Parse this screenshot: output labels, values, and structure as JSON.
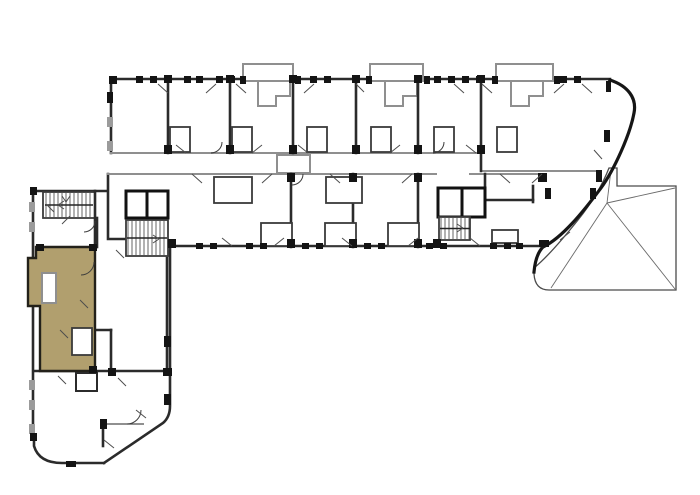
{
  "meta": {
    "title": "Residential building floor plan",
    "type": "architectural-floor-plan",
    "description": "L-shaped apartment building plan with one unit highlighted in the lower-left wing, three stair cores, top balcony bump-outs and a curved east end with a roof terrace."
  },
  "colors": {
    "background": "#ffffff",
    "wall_dark": "#2b2b2b",
    "wall_black": "#141414",
    "wall_gray": "#8f8f8f",
    "thin_line": "#4d4d4d",
    "marker_black": "#141414",
    "marker_gray": "#9b9b9b",
    "highlight_fill": "#b19f6e",
    "highlight_outline": "#23211a"
  },
  "highlighted_unit": {
    "id": "unit-lower-left",
    "status": "selected",
    "wing": "south-west"
  },
  "stairwells": [
    {
      "name": "stairwell-west",
      "x": 46,
      "y": 193,
      "w": 46,
      "h": 24,
      "step": 4
    },
    {
      "name": "stairwell-central",
      "x": 128,
      "y": 221,
      "w": 38,
      "h": 34,
      "step": 4
    },
    {
      "name": "stairwell-east",
      "x": 441,
      "y": 218,
      "w": 28,
      "h": 21,
      "step": 4
    }
  ],
  "window_markers": [
    [
      136,
      76,
      7,
      7,
      "b"
    ],
    [
      150,
      76,
      7,
      7,
      "b"
    ],
    [
      184,
      76,
      7,
      7,
      "b"
    ],
    [
      196,
      76,
      7,
      7,
      "b"
    ],
    [
      216,
      76,
      7,
      7,
      "b"
    ],
    [
      228,
      76,
      7,
      7,
      "b"
    ],
    [
      310,
      76,
      7,
      7,
      "b"
    ],
    [
      324,
      76,
      7,
      7,
      "b"
    ],
    [
      434,
      76,
      7,
      7,
      "b"
    ],
    [
      448,
      76,
      7,
      7,
      "b"
    ],
    [
      462,
      76,
      7,
      7,
      "b"
    ],
    [
      476,
      76,
      7,
      7,
      "b"
    ],
    [
      560,
      76,
      7,
      7,
      "b"
    ],
    [
      574,
      76,
      7,
      7,
      "b"
    ],
    [
      240,
      76,
      6,
      8,
      "b"
    ],
    [
      295,
      76,
      6,
      8,
      "b"
    ],
    [
      366,
      76,
      6,
      8,
      "b"
    ],
    [
      424,
      76,
      6,
      8,
      "b"
    ],
    [
      492,
      76,
      6,
      8,
      "b"
    ],
    [
      554,
      76,
      6,
      8,
      "b"
    ],
    [
      164,
      75,
      8,
      8,
      "b"
    ],
    [
      226,
      75,
      8,
      8,
      "b"
    ],
    [
      289,
      75,
      8,
      8,
      "b"
    ],
    [
      352,
      75,
      8,
      8,
      "b"
    ],
    [
      414,
      75,
      8,
      8,
      "b"
    ],
    [
      477,
      75,
      8,
      8,
      "b"
    ],
    [
      164,
      145,
      8,
      9,
      "b"
    ],
    [
      226,
      145,
      8,
      9,
      "b"
    ],
    [
      289,
      145,
      8,
      9,
      "b"
    ],
    [
      352,
      145,
      8,
      9,
      "b"
    ],
    [
      414,
      145,
      8,
      9,
      "b"
    ],
    [
      477,
      145,
      8,
      9,
      "b"
    ],
    [
      287,
      173,
      8,
      9,
      "b"
    ],
    [
      349,
      173,
      8,
      9,
      "b"
    ],
    [
      414,
      173,
      8,
      9,
      "b"
    ],
    [
      538,
      173,
      9,
      9,
      "b"
    ],
    [
      168,
      239,
      8,
      9,
      "b"
    ],
    [
      287,
      239,
      8,
      9,
      "b"
    ],
    [
      349,
      239,
      8,
      9,
      "b"
    ],
    [
      414,
      239,
      8,
      9,
      "b"
    ],
    [
      433,
      239,
      8,
      9,
      "b"
    ],
    [
      539,
      240,
      10,
      7,
      "b"
    ],
    [
      196,
      243,
      7,
      6,
      "b"
    ],
    [
      210,
      243,
      7,
      6,
      "b"
    ],
    [
      246,
      243,
      7,
      6,
      "b"
    ],
    [
      260,
      243,
      7,
      6,
      "b"
    ],
    [
      302,
      243,
      7,
      6,
      "b"
    ],
    [
      316,
      243,
      7,
      6,
      "b"
    ],
    [
      364,
      243,
      7,
      6,
      "b"
    ],
    [
      378,
      243,
      7,
      6,
      "b"
    ],
    [
      426,
      243,
      7,
      6,
      "b"
    ],
    [
      440,
      243,
      7,
      6,
      "b"
    ],
    [
      490,
      243,
      7,
      6,
      "b"
    ],
    [
      504,
      243,
      7,
      6,
      "b"
    ],
    [
      516,
      243,
      7,
      6,
      "b"
    ],
    [
      29,
      202,
      6,
      10,
      "g"
    ],
    [
      29,
      222,
      6,
      10,
      "g"
    ],
    [
      29,
      380,
      6,
      10,
      "g"
    ],
    [
      29,
      400,
      6,
      10,
      "g"
    ],
    [
      29,
      424,
      6,
      10,
      "g"
    ],
    [
      107,
      117,
      6,
      10,
      "g"
    ],
    [
      107,
      141,
      6,
      10,
      "g"
    ],
    [
      107,
      92,
      6,
      11,
      "b"
    ],
    [
      164,
      336,
      7,
      11,
      "b"
    ],
    [
      164,
      394,
      7,
      11,
      "b"
    ],
    [
      100,
      419,
      7,
      10,
      "b"
    ],
    [
      66,
      461,
      10,
      6,
      "b"
    ],
    [
      545,
      188,
      6,
      11,
      "b"
    ],
    [
      590,
      188,
      6,
      11,
      "b"
    ],
    [
      606,
      81,
      5,
      11,
      "b"
    ],
    [
      604,
      130,
      6,
      12,
      "b"
    ],
    [
      596,
      170,
      6,
      12,
      "b"
    ],
    [
      109,
      76,
      8,
      8,
      "b"
    ],
    [
      30,
      187,
      7,
      8,
      "b"
    ],
    [
      30,
      433,
      7,
      8,
      "b"
    ],
    [
      36,
      244,
      8,
      7,
      "b"
    ],
    [
      89,
      244,
      8,
      7,
      "b"
    ],
    [
      89,
      366,
      8,
      7,
      "b"
    ],
    [
      108,
      368,
      8,
      8,
      "b"
    ],
    [
      163,
      368,
      9,
      8,
      "b"
    ]
  ],
  "door_ticks": [
    [
      158,
      84,
      168,
      93
    ],
    [
      206,
      93,
      216,
      84
    ],
    [
      236,
      84,
      246,
      93
    ],
    [
      304,
      93,
      314,
      84
    ],
    [
      356,
      84,
      364,
      92
    ],
    [
      454,
      84,
      464,
      93
    ],
    [
      482,
      84,
      492,
      93
    ],
    [
      554,
      93,
      564,
      84
    ],
    [
      582,
      84,
      592,
      93
    ],
    [
      176,
      145,
      186,
      153
    ],
    [
      252,
      153,
      262,
      145
    ],
    [
      298,
      145,
      308,
      153
    ],
    [
      390,
      153,
      400,
      145
    ],
    [
      466,
      145,
      476,
      153
    ],
    [
      192,
      174,
      202,
      183
    ],
    [
      262,
      183,
      272,
      174
    ],
    [
      330,
      174,
      340,
      183
    ],
    [
      402,
      183,
      412,
      174
    ],
    [
      500,
      174,
      510,
      183
    ],
    [
      532,
      183,
      542,
      174
    ],
    [
      222,
      238,
      232,
      246
    ],
    [
      274,
      246,
      284,
      238
    ],
    [
      342,
      238,
      352,
      246
    ],
    [
      408,
      246,
      418,
      238
    ],
    [
      470,
      238,
      480,
      246
    ],
    [
      594,
      150,
      602,
      159
    ],
    [
      560,
      240,
      570,
      232
    ],
    [
      46,
      204,
      54,
      212
    ],
    [
      62,
      224,
      70,
      216
    ],
    [
      116,
      250,
      124,
      258
    ],
    [
      58,
      376,
      66,
      384
    ],
    [
      118,
      378,
      126,
      386
    ],
    [
      136,
      410,
      146,
      418
    ],
    [
      104,
      440,
      114,
      448
    ],
    [
      80,
      300,
      88,
      308
    ],
    [
      60,
      330,
      68,
      338
    ],
    [
      62,
      196,
      66,
      202
    ],
    [
      66,
      202,
      70,
      196
    ],
    [
      58,
      205,
      64,
      201
    ],
    [
      58,
      205,
      64,
      209
    ],
    [
      159,
      239,
      153,
      235
    ],
    [
      159,
      239,
      153,
      243
    ],
    [
      463,
      228,
      457,
      224
    ],
    [
      463,
      228,
      457,
      232
    ]
  ]
}
